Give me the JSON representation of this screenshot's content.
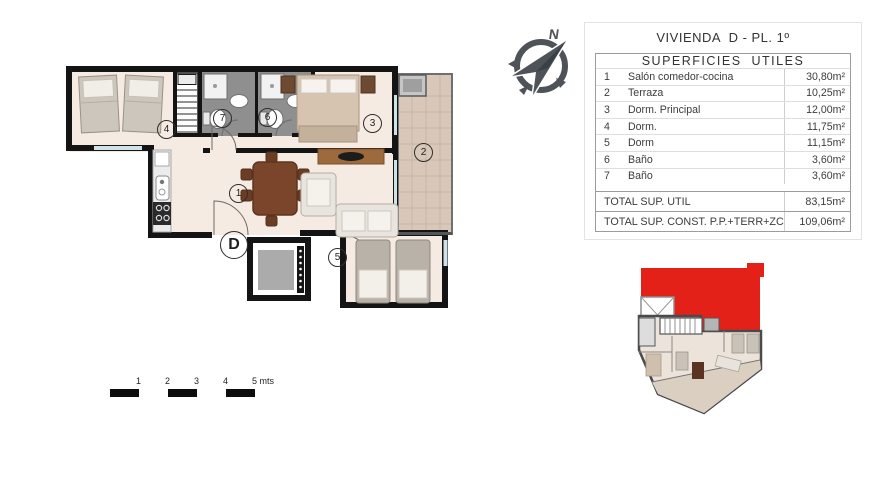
{
  "header": {
    "title": "VIVIENDA  D - PL. 1º"
  },
  "areas_table": {
    "title": "SUPERFICIES  UTILES",
    "rows": [
      {
        "num": "1",
        "label": "Salón comedor-cocina",
        "value": "30,80m²"
      },
      {
        "num": "2",
        "label": "Terraza",
        "value": "10,25m²"
      },
      {
        "num": "3",
        "label": "Dorm. Principal",
        "value": "12,00m²"
      },
      {
        "num": "4",
        "label": "Dorm.",
        "value": "11,75m²"
      },
      {
        "num": "5",
        "label": "Dorm",
        "value": "11,15m²"
      },
      {
        "num": "6",
        "label": "Baño",
        "value": "3,60m²"
      },
      {
        "num": "7",
        "label": "Baño",
        "value": "3,60m²"
      }
    ],
    "totals": [
      {
        "label": "TOTAL SUP. UTIL",
        "value": "83,15m²"
      },
      {
        "label": "TOTAL SUP. CONST. P.P.+TERR+ZC",
        "value": "109,06m²"
      }
    ]
  },
  "floor_plan": {
    "unit_letter": "D",
    "room_numbers": [
      "1",
      "2",
      "3",
      "4",
      "5",
      "6",
      "7"
    ]
  },
  "compass": {
    "north": "N"
  },
  "scale_bar": {
    "labels": [
      "1",
      "2",
      "3",
      "4",
      "5 mts"
    ]
  },
  "colors": {
    "wall": "#141414",
    "floor": "#f6ebe2",
    "terrace_tile": "#d9c8b9",
    "bath_floor": "#8f8f8f",
    "window": "#cfe2ea",
    "highlight_red": "#e32119",
    "compass_gray": "#4d5358"
  }
}
